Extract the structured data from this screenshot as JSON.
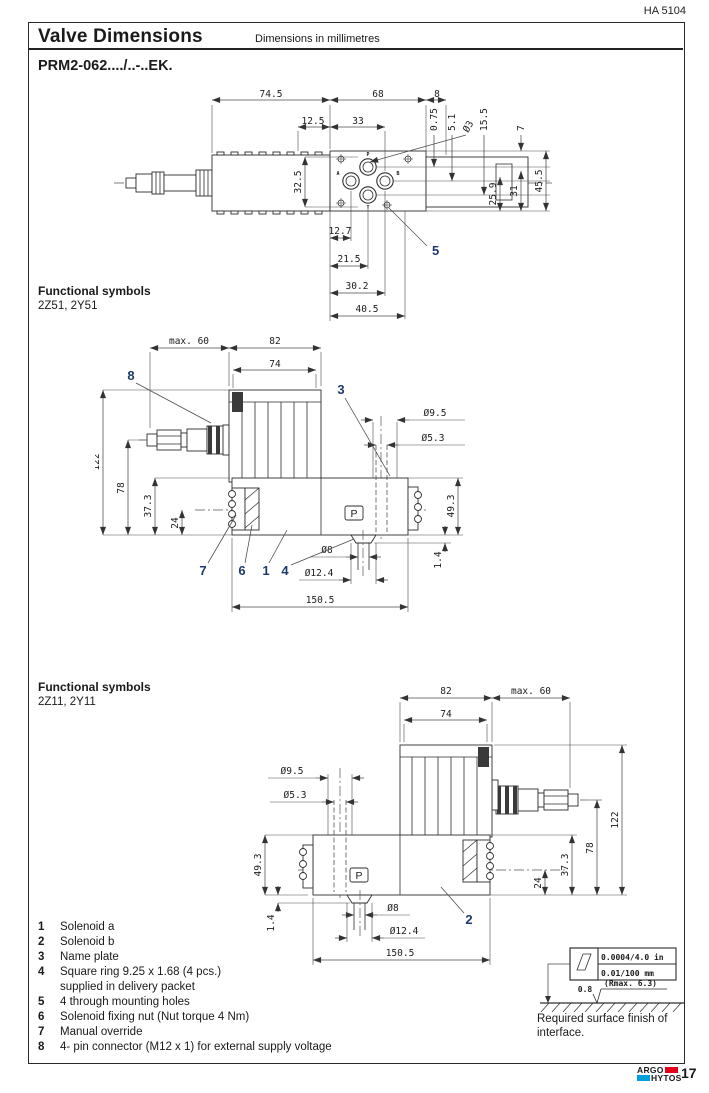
{
  "header": {
    "doc_code": "HA 5104",
    "title": "Valve Dimensions",
    "units_note": "Dimensions in millimetres",
    "model": "PRM2-062..../..-..EK."
  },
  "functional_symbols_1": {
    "heading": "Functional symbols",
    "codes": "2Z51, 2Y51"
  },
  "functional_symbols_2": {
    "heading": "Functional symbols",
    "codes": "2Z11, 2Y11"
  },
  "top_view": {
    "dims": {
      "solenoid_len": "74.5",
      "body_len": "68",
      "end_len": "8",
      "off1": "12.5",
      "off2": "33",
      "pin_hole": "Ø3",
      "p075": "0.75",
      "p51": "5.1",
      "p155": "15.5",
      "p7": "7",
      "pattern_h": "32.5",
      "p259": "25.9",
      "p31": "31",
      "p455": "45.5",
      "x127": "12.7",
      "x215": "21.5",
      "x302": "30.2",
      "x405": "40.5"
    },
    "ports": {
      "p": "P",
      "a": "A",
      "b": "B",
      "t": "T"
    },
    "callout_5": "5"
  },
  "side_view_1": {
    "dims": {
      "max60": "max. 60",
      "w82": "82",
      "w74": "74",
      "h122": "122",
      "h78": "78",
      "h373": "37.3",
      "h24": "24",
      "d95": "Ø9.5",
      "d53": "Ø5.3",
      "h493": "49.3",
      "h14": "1.4",
      "d8": "Ø8",
      "d124": "Ø12.4",
      "w1505": "150.5"
    },
    "port_label": "P",
    "callouts": {
      "c8": "8",
      "c3": "3",
      "c7": "7",
      "c6": "6",
      "c1": "1",
      "c4": "4"
    }
  },
  "side_view_2": {
    "dims": {
      "w82": "82",
      "w74": "74",
      "max60": "max. 60",
      "d95": "Ø9.5",
      "d53": "Ø5.3",
      "h493": "49.3",
      "h14": "1.4",
      "d8": "Ø8",
      "d124": "Ø12.4",
      "w1505": "150.5",
      "h24": "24",
      "h373": "37.3",
      "h78": "78",
      "h122": "122"
    },
    "port_label": "P",
    "callouts": {
      "c2": "2"
    }
  },
  "legend": {
    "items": [
      {
        "num": "1",
        "text": "Solenoid a"
      },
      {
        "num": "2",
        "text": "Solenoid b"
      },
      {
        "num": "3",
        "text": "Name plate"
      },
      {
        "num": "4",
        "text": "Square ring 9.25 x 1.68 (4 pcs.)",
        "text2": "supplied in delivery packet"
      },
      {
        "num": "5",
        "text": "4 through mounting holes"
      },
      {
        "num": "6",
        "text": "Solenoid fixing nut (Nut torque 4 Nm)"
      },
      {
        "num": "7",
        "text": "Manual override"
      },
      {
        "num": "8",
        "text": "4- pin connector (M12 x 1) for external supply voltage"
      }
    ]
  },
  "surface_finish": {
    "flatness_in": "0.0004/4.0 in",
    "flatness_mm": "0.01/100 mm",
    "roughness": "0.8",
    "rmax": "(Rmax. 6.3)",
    "caption": "Required surface finish of interface."
  },
  "footer": {
    "brand_line1": "ARGO",
    "brand_line2": "HYTOS",
    "page_number": "17"
  },
  "colors": {
    "callout": "#1d3a6d",
    "logo_red": "#e2001a",
    "logo_cyan": "#00a0df"
  }
}
